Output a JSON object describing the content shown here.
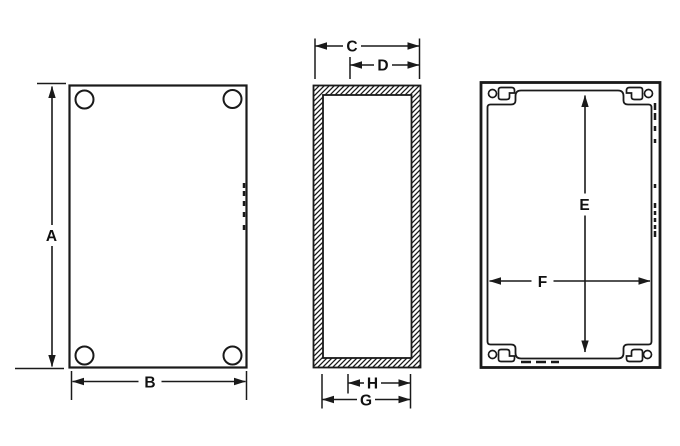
{
  "drawing": {
    "background": "#ffffff",
    "ink_color": "#1a1a1a",
    "dimension_labels": {
      "A": "A",
      "B": "B",
      "C": "C",
      "D": "D",
      "E": "E",
      "F": "F",
      "G": "G",
      "H": "H"
    }
  }
}
